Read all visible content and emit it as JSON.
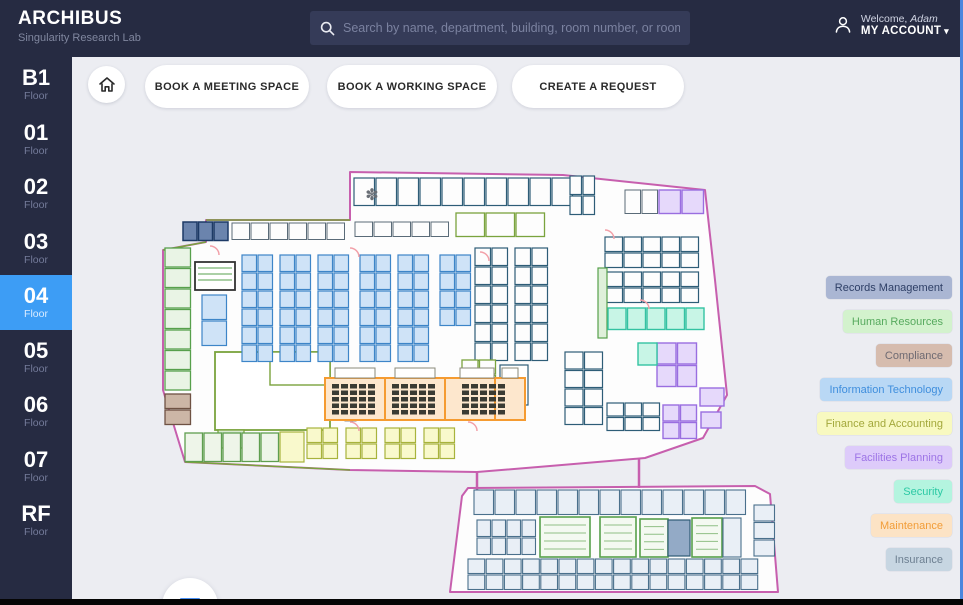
{
  "header": {
    "app_title": "ARCHIBUS",
    "app_subtitle": "Singularity Research Lab",
    "search_placeholder": "Search by name, department, building, room number, or room type",
    "welcome_label": "Welcome,",
    "user_name": "Adam",
    "account_label": "MY ACCOUNT",
    "account_caret": "▾"
  },
  "sidebar": {
    "floors": [
      {
        "label": "B1",
        "sublabel": "Floor",
        "active": false
      },
      {
        "label": "01",
        "sublabel": "Floor",
        "active": false
      },
      {
        "label": "02",
        "sublabel": "Floor",
        "active": false
      },
      {
        "label": "03",
        "sublabel": "Floor",
        "active": false
      },
      {
        "label": "04",
        "sublabel": "Floor",
        "active": true
      },
      {
        "label": "05",
        "sublabel": "Floor",
        "active": false
      },
      {
        "label": "06",
        "sublabel": "Floor",
        "active": false
      },
      {
        "label": "07",
        "sublabel": "Floor",
        "active": false
      },
      {
        "label": "RF",
        "sublabel": "Floor",
        "active": false
      }
    ]
  },
  "toolbar": {
    "buttons": [
      "BOOK A MEETING SPACE",
      "BOOK A WORKING SPACE",
      "CREATE A REQUEST"
    ]
  },
  "legend": {
    "items": [
      {
        "label": "Records Management",
        "bg": "#aab6d3",
        "text": "#2e3f66"
      },
      {
        "label": "Human Resources",
        "bg": "#d3f2cd",
        "text": "#57aa5e"
      },
      {
        "label": "Compliance",
        "bg": "#d6bcae",
        "text": "#6e6a72"
      },
      {
        "label": "Information Technology",
        "bg": "#b9d8f5",
        "text": "#3f8edd"
      },
      {
        "label": "Finance and Accounting",
        "bg": "#f8f9c0",
        "text": "#a3a83b"
      },
      {
        "label": "Facilities Planning",
        "bg": "#ddcbfa",
        "text": "#9d74e6"
      },
      {
        "label": "Security",
        "bg": "#b4f4df",
        "text": "#2cc9a4"
      },
      {
        "label": "Maintenance",
        "bg": "#fce3c5",
        "text": "#f29d38"
      },
      {
        "label": "Insurance",
        "bg": "#c7d6e2",
        "text": "#6e8092"
      }
    ]
  },
  "colors": {
    "header_bg": "#262b42",
    "sidebar_bg": "#262b42",
    "active_floor_bg": "#3d9df5",
    "content_bg": "#ecedf2",
    "accent_blue": "#4a90f4",
    "window_edge_blue": "#4b86dd",
    "plan_outline": "#c75fae",
    "plan_wall_olive": "#7aa33d"
  }
}
